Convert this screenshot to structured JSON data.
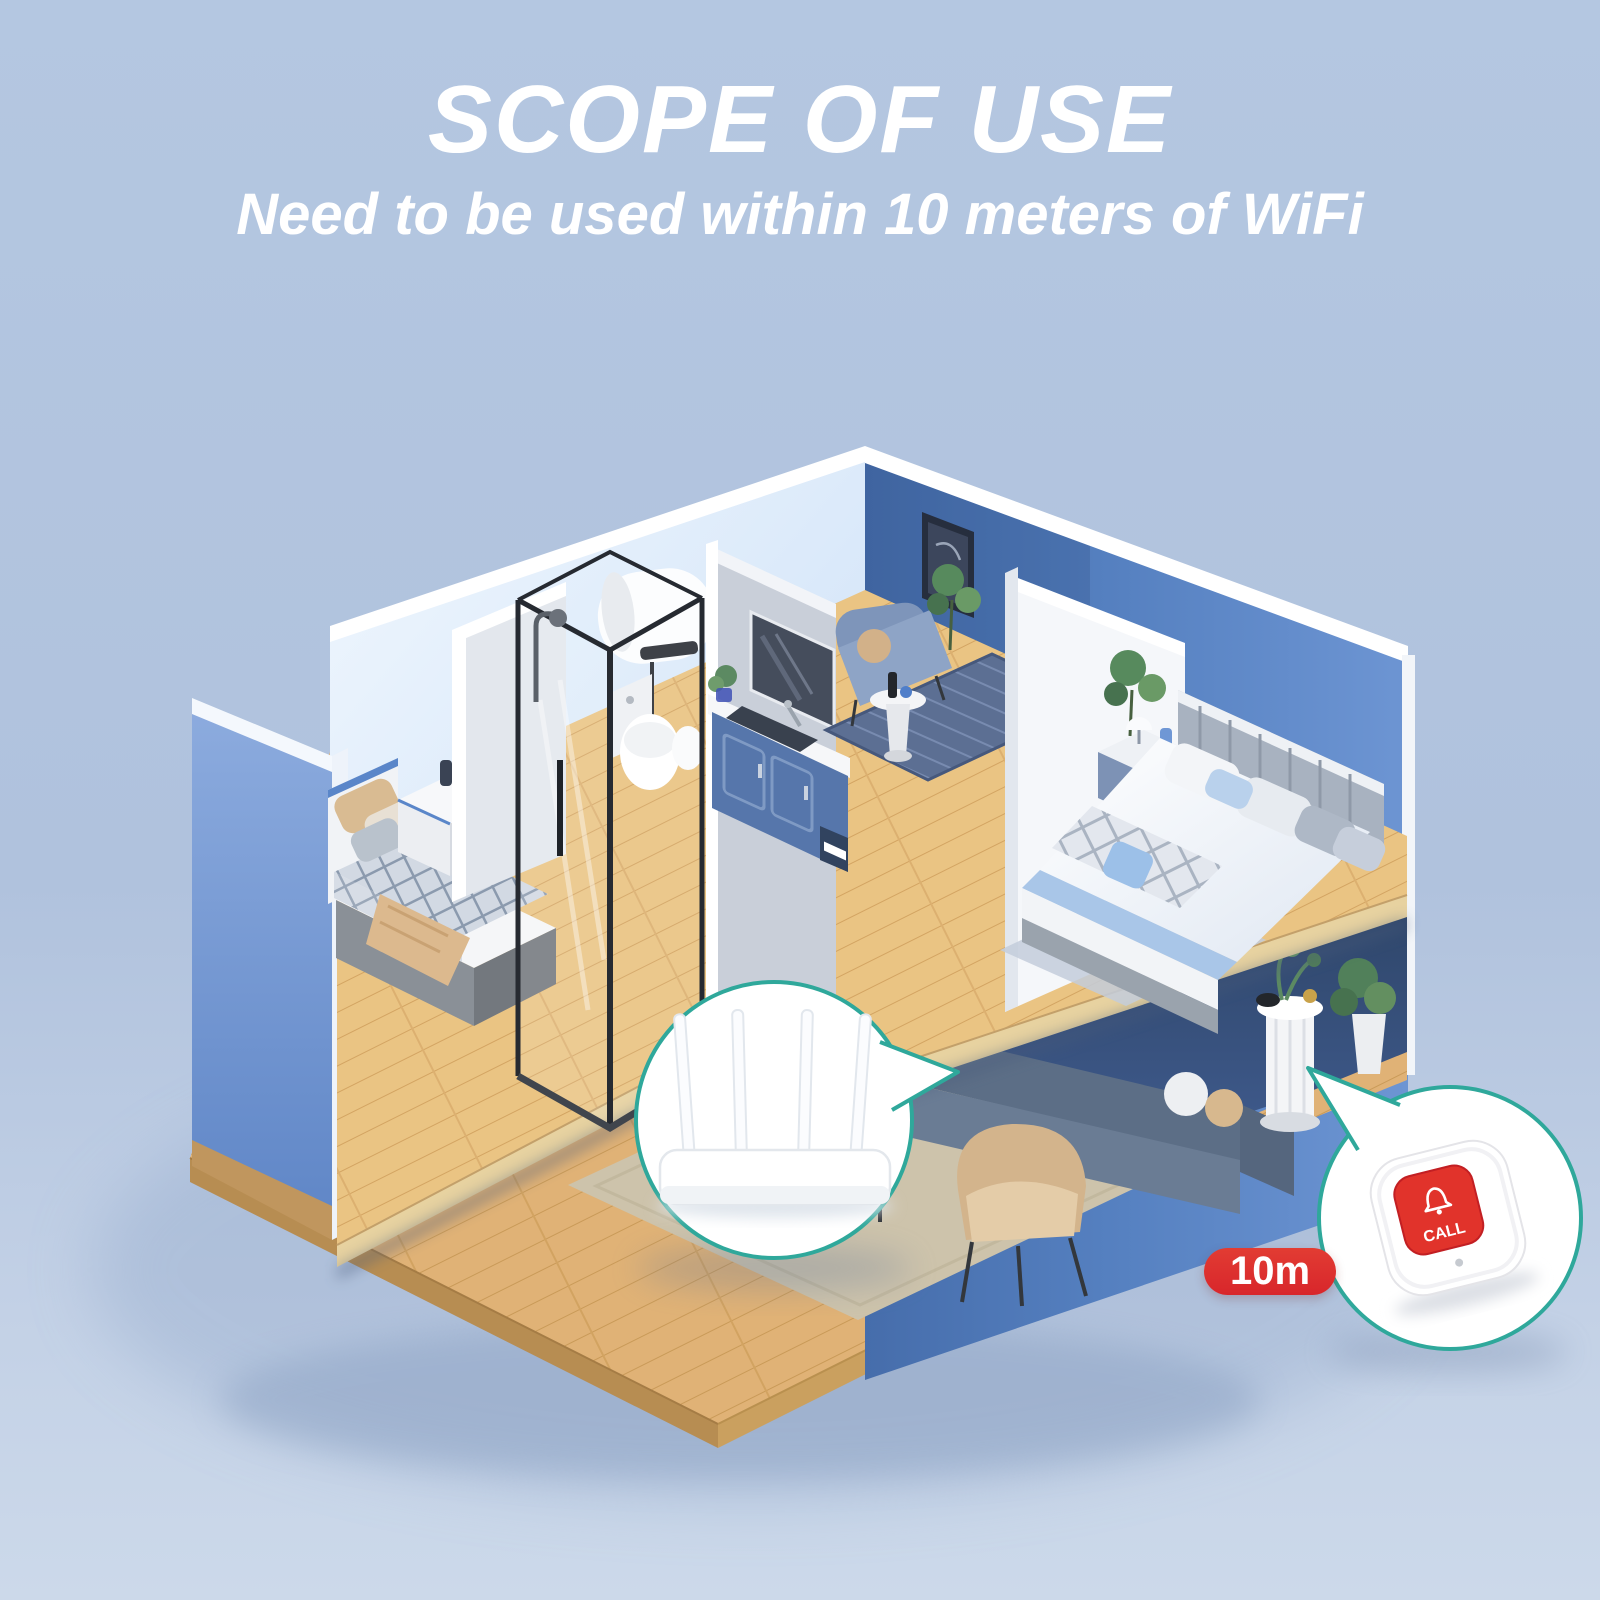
{
  "header": {
    "title": "SCOPE OF USE",
    "subtitle": "Need to be used within 10 meters of WiFi"
  },
  "callout_button": {
    "label": "CALL",
    "badge": "10m",
    "icon": "bell-icon"
  },
  "callout_router": {
    "icon": "wifi-router"
  },
  "colors": {
    "background": "#b4c7e1",
    "title": "#ffffff",
    "teal": "#2fa89b",
    "red": "#d8262b",
    "button_red": "#e1332b",
    "wall_blue": "#6f97d5",
    "wall_navy": "#3c5a8c",
    "wall_light": "#d7e8fa",
    "partition": "#f5f7fa",
    "wood": "#e3b97d",
    "wood_edge": "#e9d4a4"
  },
  "scene": {
    "rooms": [
      {
        "name": "left-bedroom",
        "items": [
          "single-bed",
          "nightstand",
          "toys"
        ]
      },
      {
        "name": "bathroom",
        "items": [
          "shower-enclosure",
          "water-heater",
          "toilet",
          "vanity-sink",
          "mirror"
        ]
      },
      {
        "name": "sitting-nook",
        "items": [
          "armchair",
          "side-table",
          "rug",
          "wall-art",
          "plant"
        ]
      },
      {
        "name": "right-bedroom",
        "items": [
          "double-bed",
          "nightstand",
          "table-lamp",
          "plant"
        ]
      },
      {
        "name": "living-room",
        "items": [
          "sofa",
          "coffee-table",
          "armchair",
          "rug",
          "pedestal-table",
          "plant"
        ]
      }
    ]
  }
}
